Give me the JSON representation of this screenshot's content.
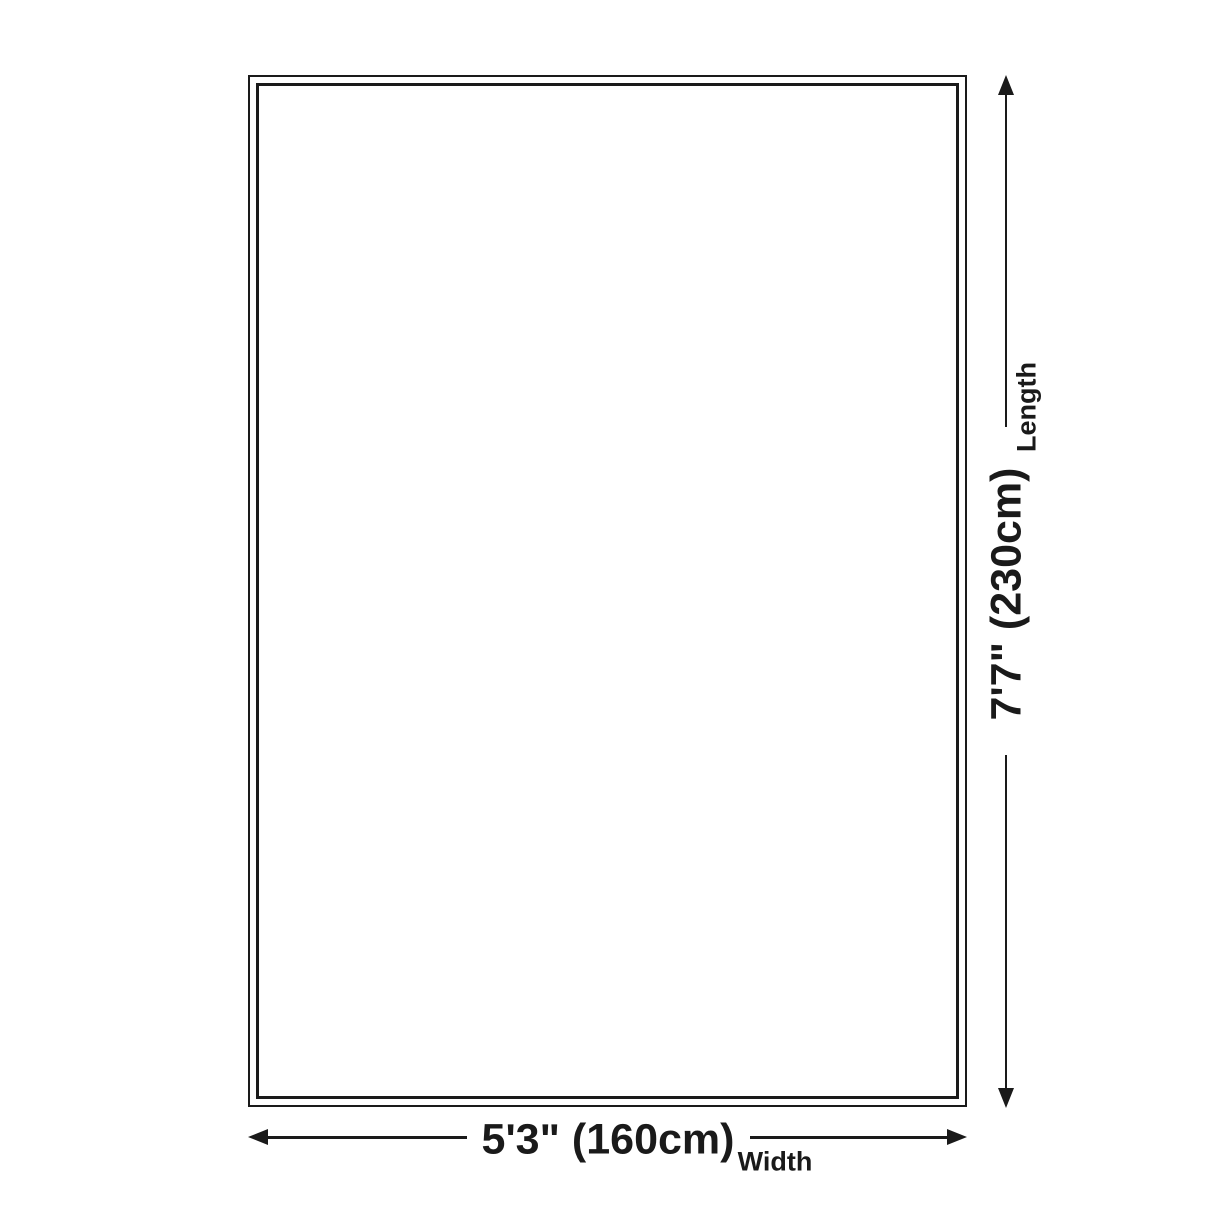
{
  "colors": {
    "background": "#ffffff",
    "line": "#1a1a1a",
    "text": "#1a1a1a"
  },
  "dimensions": {
    "length": {
      "value": "7'7\" (230cm)",
      "label": "Length"
    },
    "width": {
      "value": "5'3\" (160cm)",
      "label": "Width"
    }
  }
}
